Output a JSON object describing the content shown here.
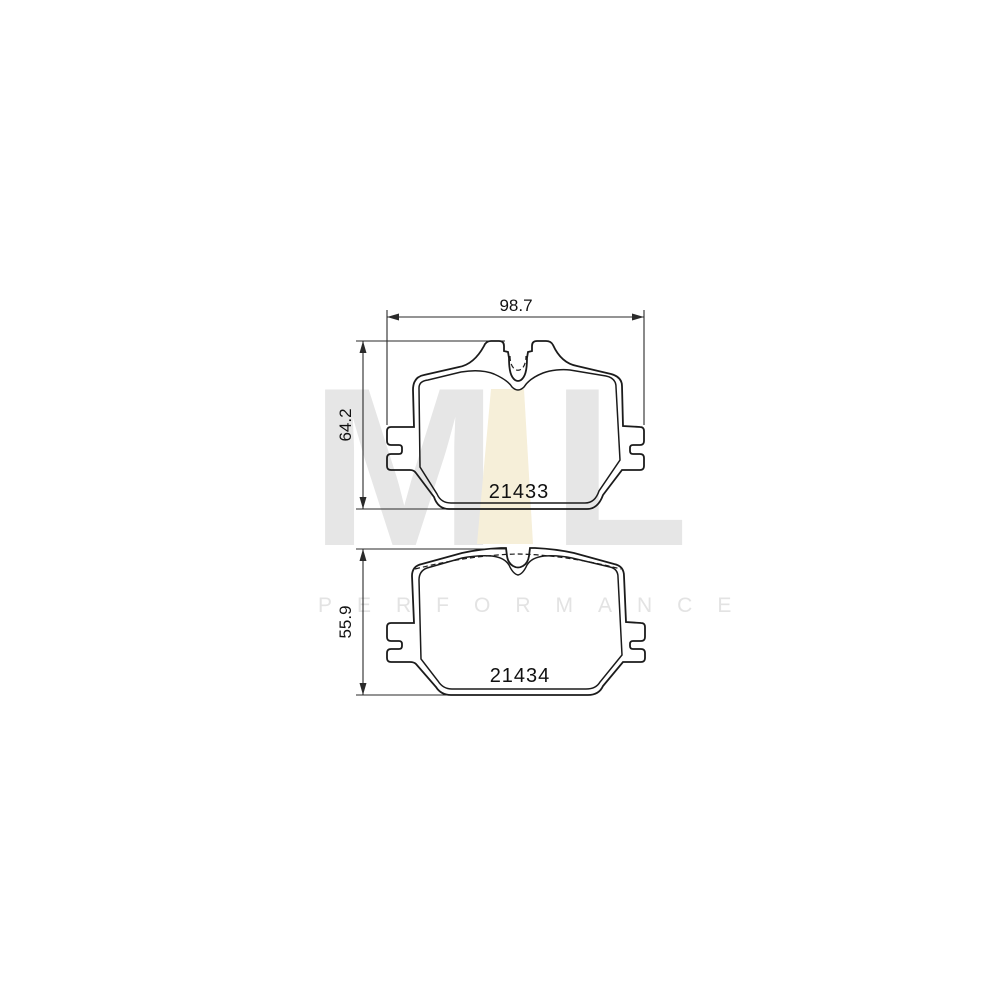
{
  "diagram": {
    "line_color": "#1b1b1b",
    "dim_color": "#2a2a2a",
    "dimensions": {
      "width": {
        "label": "98.7"
      },
      "height_pad1": {
        "label": "64.2"
      },
      "height_pad2": {
        "label": "55.9"
      }
    },
    "pads": [
      {
        "part_number": "21433"
      },
      {
        "part_number": "21434"
      }
    ]
  },
  "watermark": {
    "logo_m": "M",
    "logo_l": "L",
    "text": "PERFORMANCE",
    "gray": "#e6e6e6",
    "yellow": "#f6efd9",
    "text_color": "#e3e3e3"
  }
}
